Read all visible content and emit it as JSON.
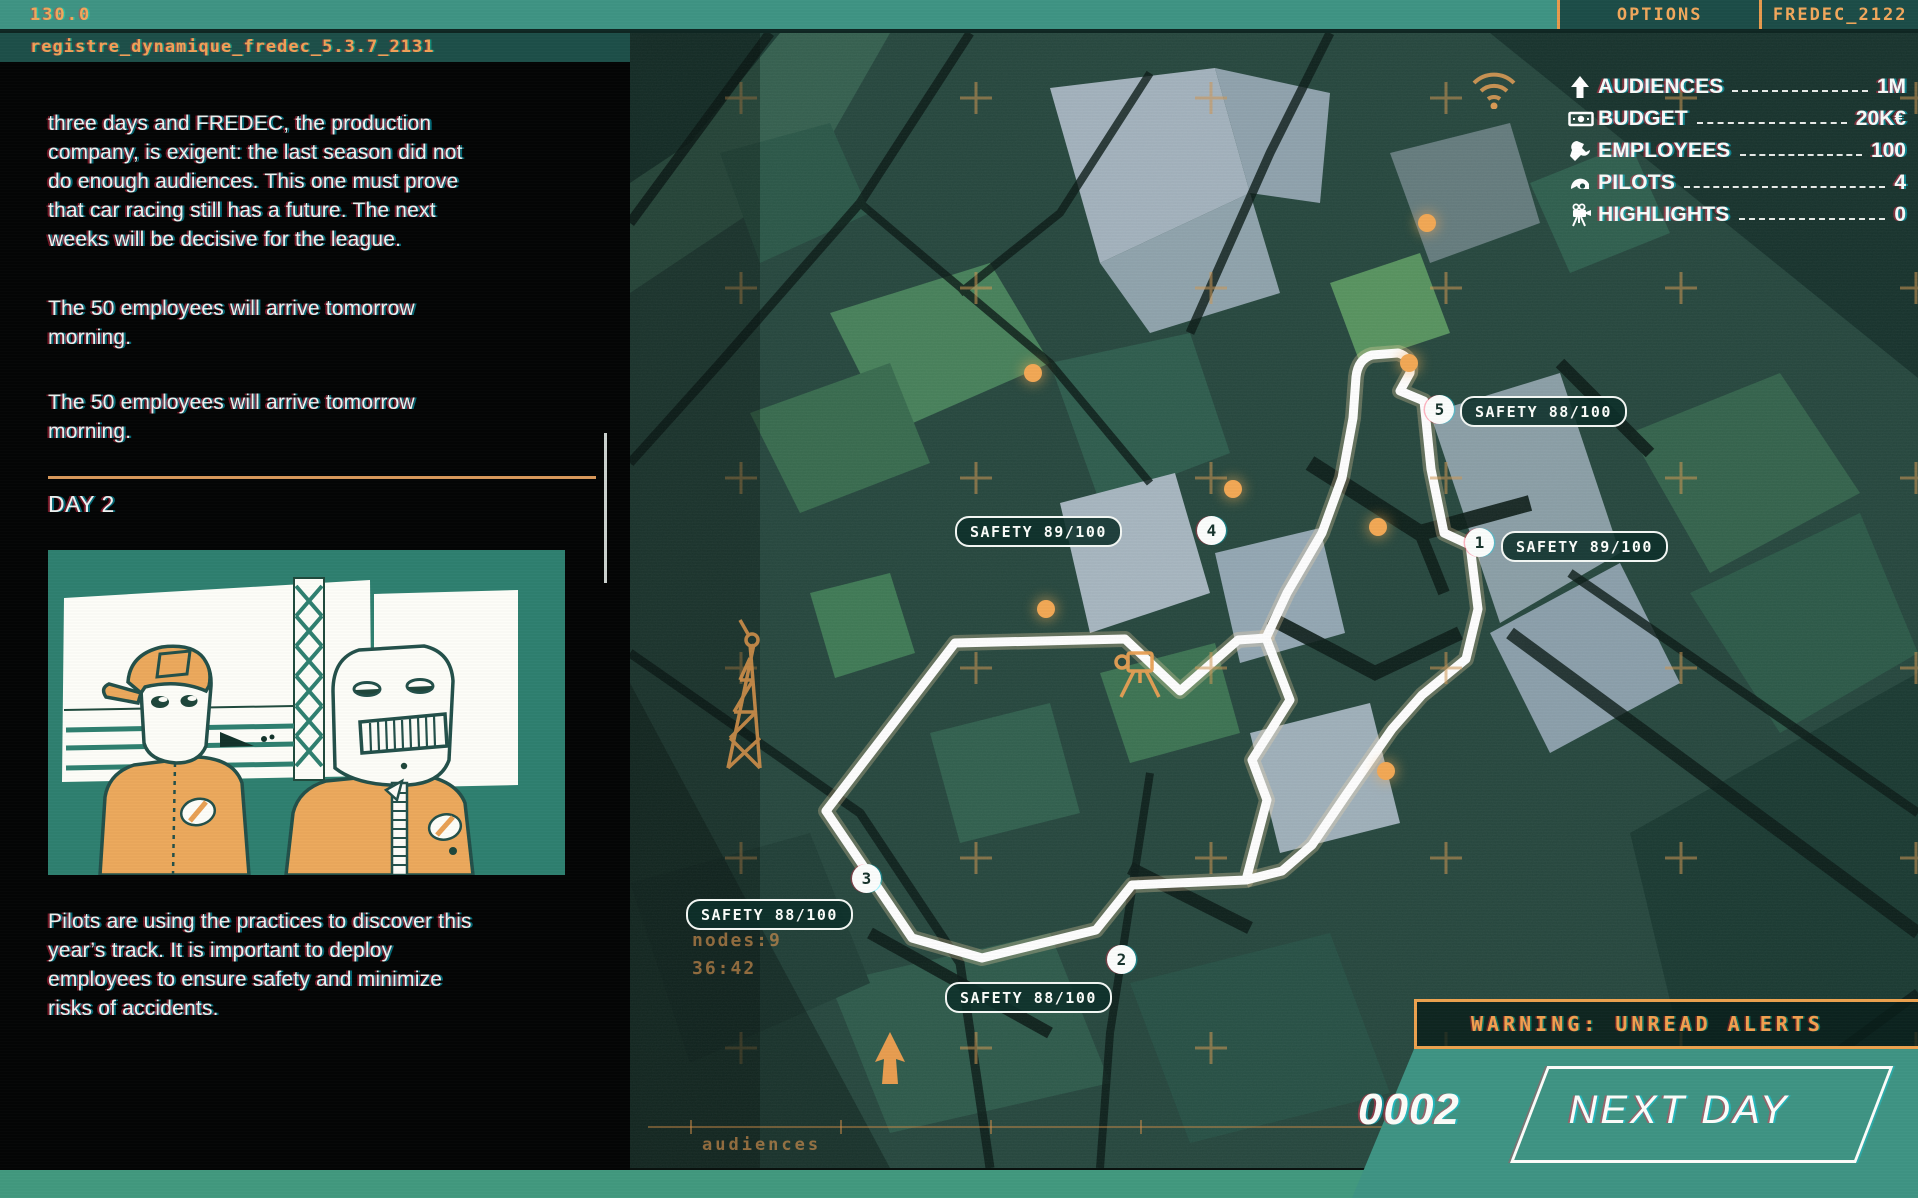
{
  "top_bar": {
    "frequency": "130.0",
    "options_label": "OPTIONS",
    "session_label": "FREDEC_2122"
  },
  "log_panel": {
    "header": "registre_dynamique_fredec_5.3.7_2131",
    "paragraphs": [
      "three days and FREDEC, the production company, is exigent: the last season did not do enough audiences. This one must prove that car racing still has a future. The next weeks will be decisive for the league.",
      "The 50 employees will arrive tomorrow morning.",
      "The 50 employees will arrive tomorrow morning."
    ],
    "day_heading": "DAY 2",
    "footer_paragraph": "Pilots are using the practices to discover this year’s track. It is important to deploy employees to ensure safety and minimize risks of accidents."
  },
  "stats": {
    "rows": [
      {
        "icon": "arrow-up-icon",
        "label": "AUDIENCES",
        "value": "1M"
      },
      {
        "icon": "banknote-icon",
        "label": "BUDGET",
        "value": "20K€"
      },
      {
        "icon": "wrench-icon",
        "label": "EMPLOYEES",
        "value": "100"
      },
      {
        "icon": "helmet-icon",
        "label": "PILOTS",
        "value": "4"
      },
      {
        "icon": "camera-tripod-icon",
        "label": "HIGHLIGHTS",
        "value": "0"
      }
    ]
  },
  "map": {
    "nodes": [
      {
        "number": "5",
        "safety": "SAFETY 88/100"
      },
      {
        "number": "4",
        "safety": "SAFETY 89/100"
      },
      {
        "number": "1",
        "safety": "SAFETY 89/100"
      },
      {
        "number": "3",
        "safety": "SAFETY 88/100"
      },
      {
        "number": "2",
        "safety": "SAFETY 88/100"
      }
    ],
    "hud": {
      "nodes_count": "nodes:9",
      "timer": "36:42",
      "axis_label": "audiences"
    }
  },
  "alerts": {
    "warning": "WARNING: UNREAD ALERTS"
  },
  "day_controls": {
    "day_counter": "0002",
    "next_day_label": "NEXT DAY"
  },
  "colors": {
    "accent_orange": "#e8a054",
    "teal": "#3f9484",
    "panel_bg": "#040505",
    "badge_bg": "#0d302a",
    "track_white": "#ffffff"
  }
}
